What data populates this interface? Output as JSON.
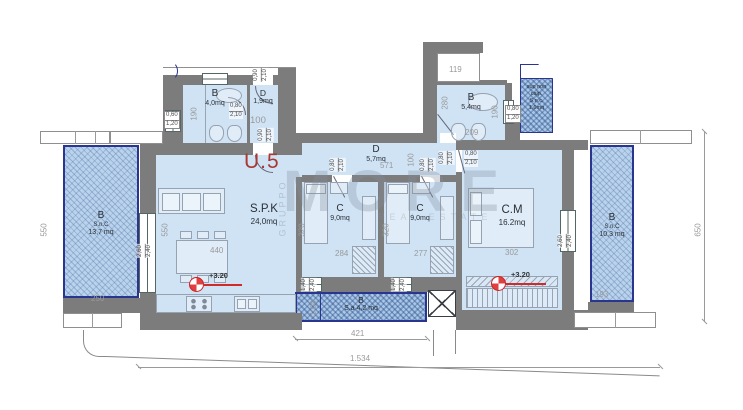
{
  "unit_label": "U.5",
  "watermark": {
    "main": "MORE",
    "side": "GRUPPO",
    "sub": "REAL ESTATE"
  },
  "rooms": {
    "bath1": {
      "name": "B",
      "area": "4,0mq"
    },
    "entry": {
      "name": "D",
      "area": "1,9mq"
    },
    "bath2": {
      "name": "B",
      "area": "5,4mq"
    },
    "snc": {
      "l1": "sup non",
      "l2": "calp.",
      "l3": "S.n.c.",
      "l4": "1,6mq"
    },
    "spk": {
      "name": "S.P.K",
      "area": "24,0mq"
    },
    "hall": {
      "name": "D",
      "area": "5,7mq"
    },
    "c1": {
      "name": "C",
      "area": "9,0mq"
    },
    "c2": {
      "name": "C",
      "area": "9,0mq"
    },
    "cm": {
      "name": "C.M",
      "area": "16.2mq"
    },
    "balcony_left": {
      "name": "B",
      "type": "S.n.C",
      "area": "13,7 mq"
    },
    "balcony_right": {
      "name": "B",
      "type": "S.n.C",
      "area": "10,3 mq"
    },
    "balcony_bottom": {
      "name": "B",
      "area": "S.a 4,2 mq"
    }
  },
  "dims": {
    "b119": "119",
    "b280": "280",
    "b190": "190",
    "b209": "209",
    "bath1_190": "190",
    "entry_100": "100",
    "hall_571": "571",
    "hall_100": "100",
    "left_550": "550",
    "spk_550": "550",
    "spk_440": "440",
    "c1_320": "320",
    "c1_284": "284",
    "c2_320": "320",
    "c2_277": "277",
    "cm_302": "302",
    "balcl_250": "250",
    "balcr_193": "193",
    "balcb_421": "421",
    "balcb_100": "1,00",
    "total_1534": "1.534",
    "right_650": "650"
  },
  "openings": {
    "win_a": {
      "top": "0,60",
      "bot": "1,20"
    },
    "door_s": {
      "top": "0,80",
      "bot": "2,10"
    },
    "door_m": {
      "top": "0,90",
      "bot": "2,10"
    },
    "win_b": {
      "top": "0,80",
      "bot": "1,20"
    },
    "win_c": {
      "top": "2,60",
      "bot": "2,40"
    },
    "win_d": {
      "top": "1,40",
      "bot": "2,40"
    }
  },
  "level_marker": "+3.20",
  "colors": {
    "room_fill": "#cfe3f5",
    "balcony_fill": "#b9d3ec",
    "wall": "#7c7c7c",
    "accent_red": "#cf2b2b",
    "navy_border": "#2a3590",
    "dim_text": "#9a9a9a"
  }
}
